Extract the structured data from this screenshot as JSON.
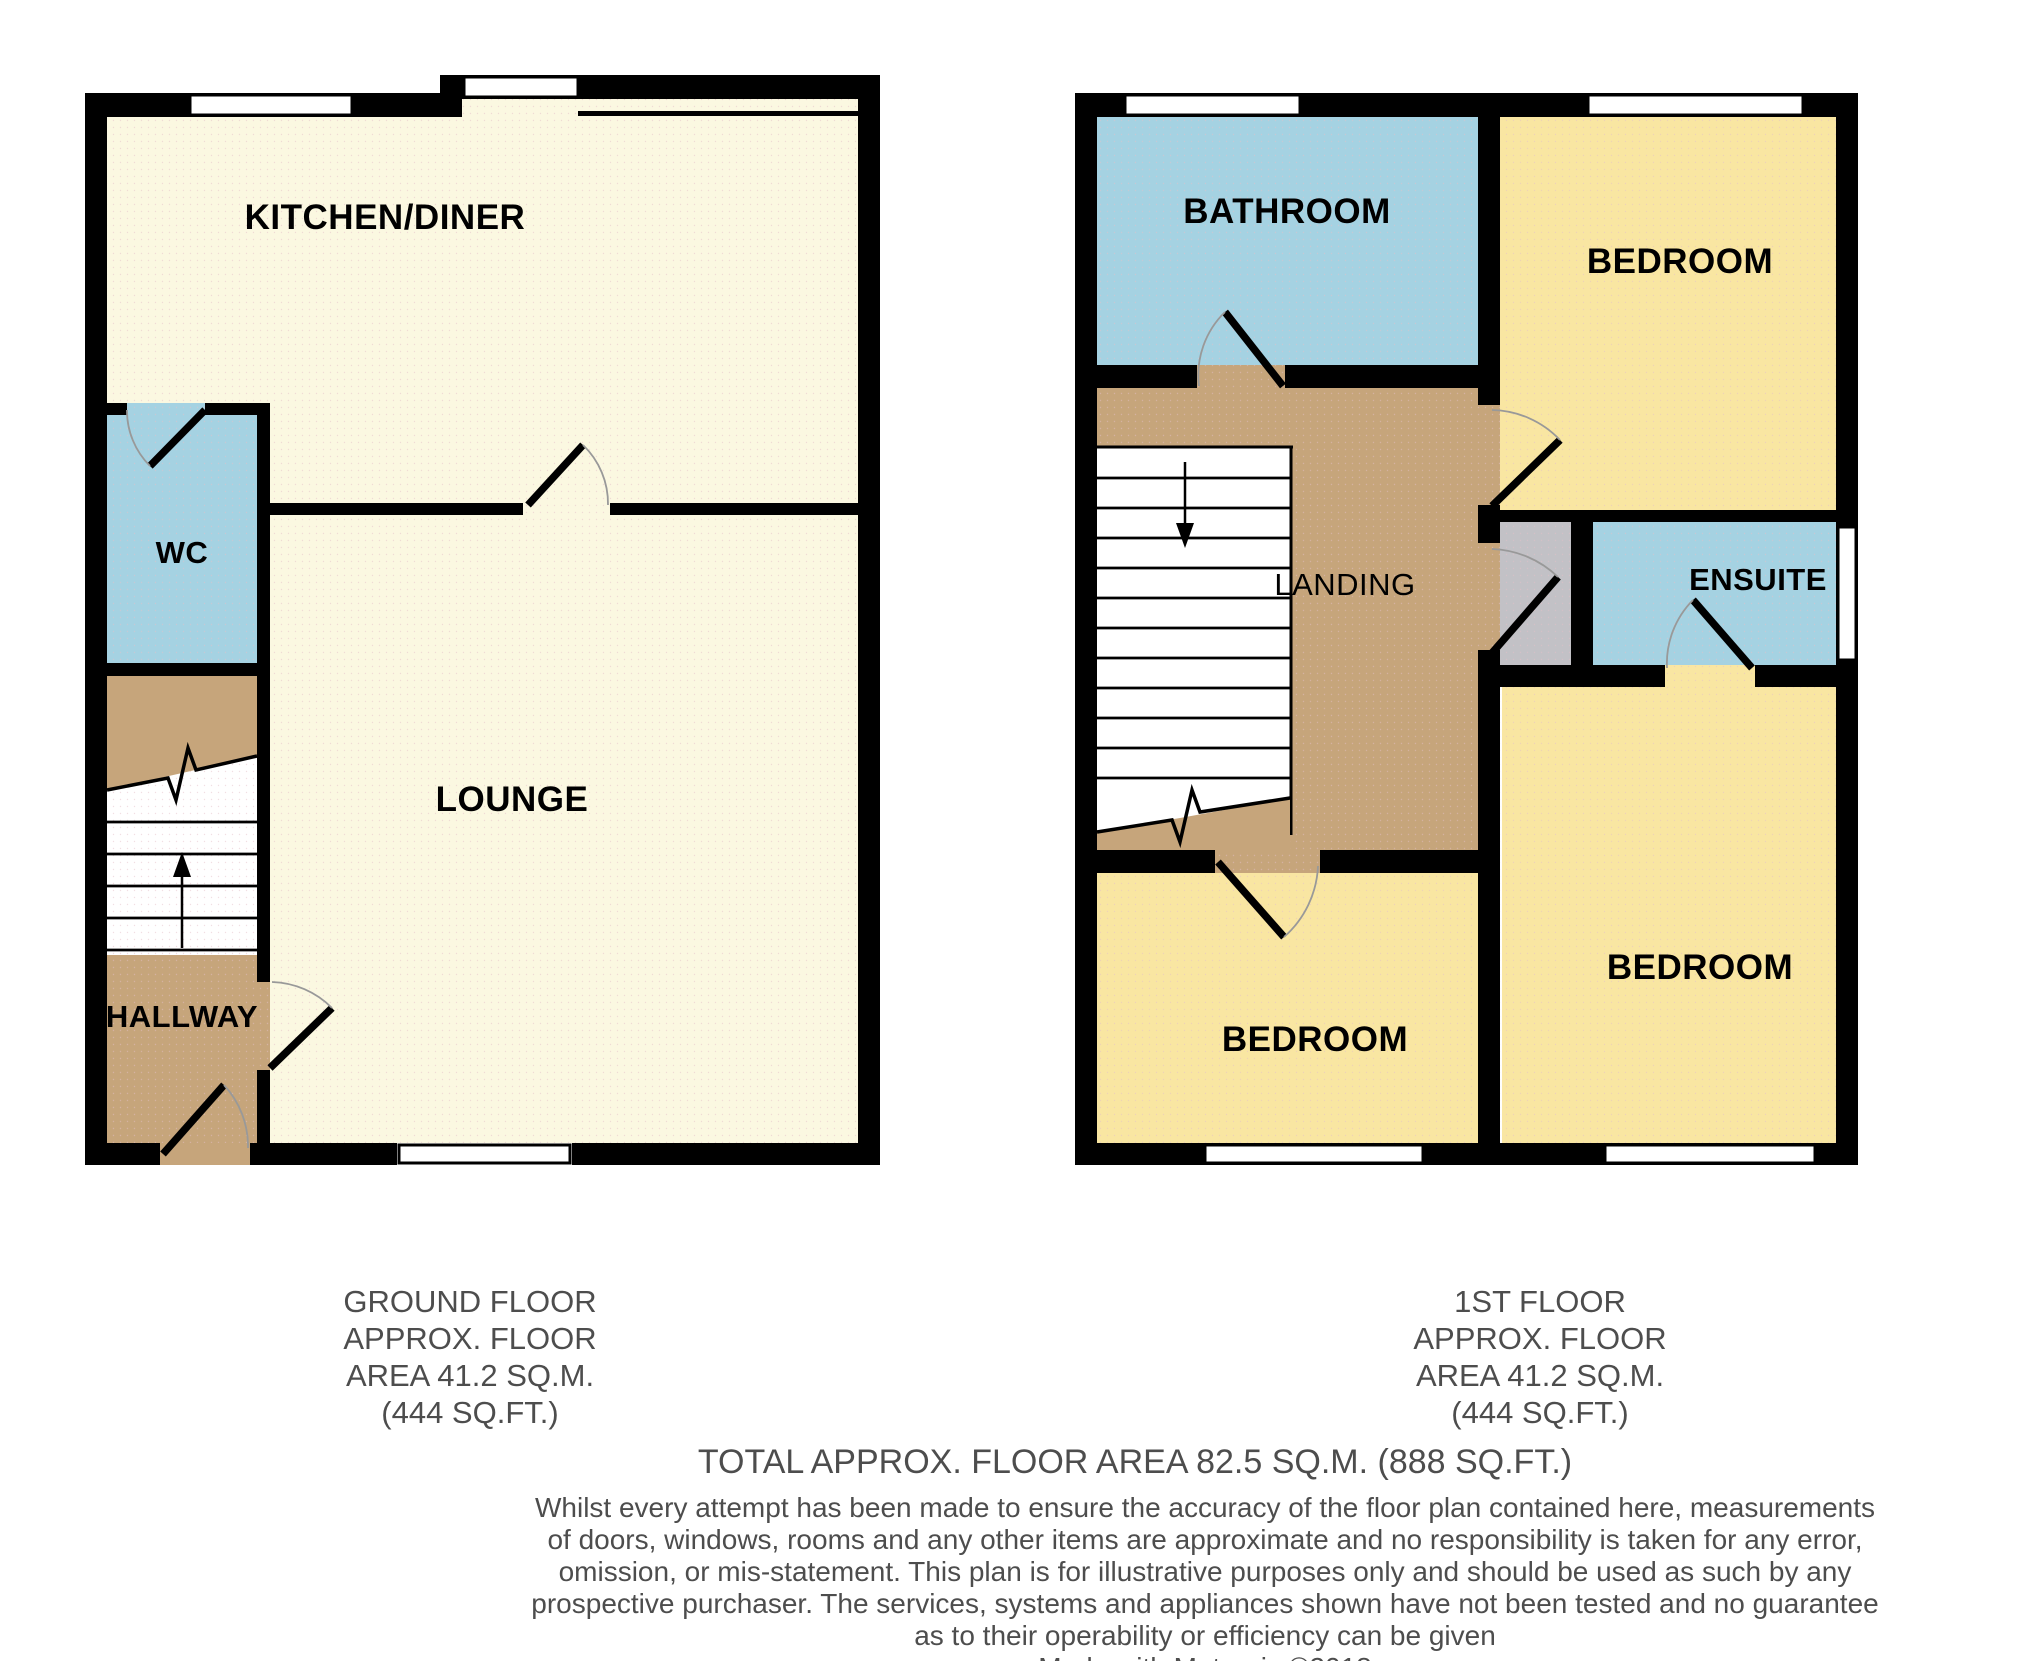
{
  "ground_floor": {
    "kitchen_diner": "KITCHEN/DINER",
    "wc": "WC",
    "lounge": "LOUNGE",
    "hallway": "HALLWAY"
  },
  "first_floor": {
    "bathroom": "BATHROOM",
    "bedroom_top_right": "BEDROOM",
    "landing": "LANDING",
    "ensuite": "ENSUITE",
    "bedroom_bottom_left": "BEDROOM",
    "bedroom_bottom_right": "BEDROOM"
  },
  "captions": {
    "ground": [
      "GROUND FLOOR",
      "APPROX. FLOOR",
      "AREA 41.2 SQ.M.",
      "(444 SQ.FT.)"
    ],
    "first": [
      "1ST FLOOR",
      "APPROX. FLOOR",
      "AREA 41.2 SQ.M.",
      "(444 SQ.FT.)"
    ],
    "total": "TOTAL APPROX. FLOOR AREA 82.5 SQ.M. (888 SQ.FT.)",
    "disclaimer": [
      "Whilst every attempt has been made to ensure the accuracy of the floor plan contained here, measurements",
      "of doors, windows, rooms and any other items are approximate and no responsibility is taken for any error,",
      "omission, or mis-statement. This plan is for illustrative purposes only and should be used as such by any",
      "prospective purchaser. The services, systems and appliances shown have not been tested and no guarantee",
      "as to their operability or efficiency can be given"
    ],
    "credit": "Made with Metropix ©2018"
  },
  "colors": {
    "wall_black": "#000000",
    "room_cream": "#FBF8E1",
    "room_yellow": "#F9E6A2",
    "room_blue": "#A5D2E2",
    "floor_tan": "#C6A57B",
    "cupboard_gray": "#C2C1C6",
    "stair_white": "#FFFFFF",
    "door_arc_gray": "#999999",
    "caption_gray": "#4D4D4D",
    "dot_pink": "#E3C0C8"
  }
}
